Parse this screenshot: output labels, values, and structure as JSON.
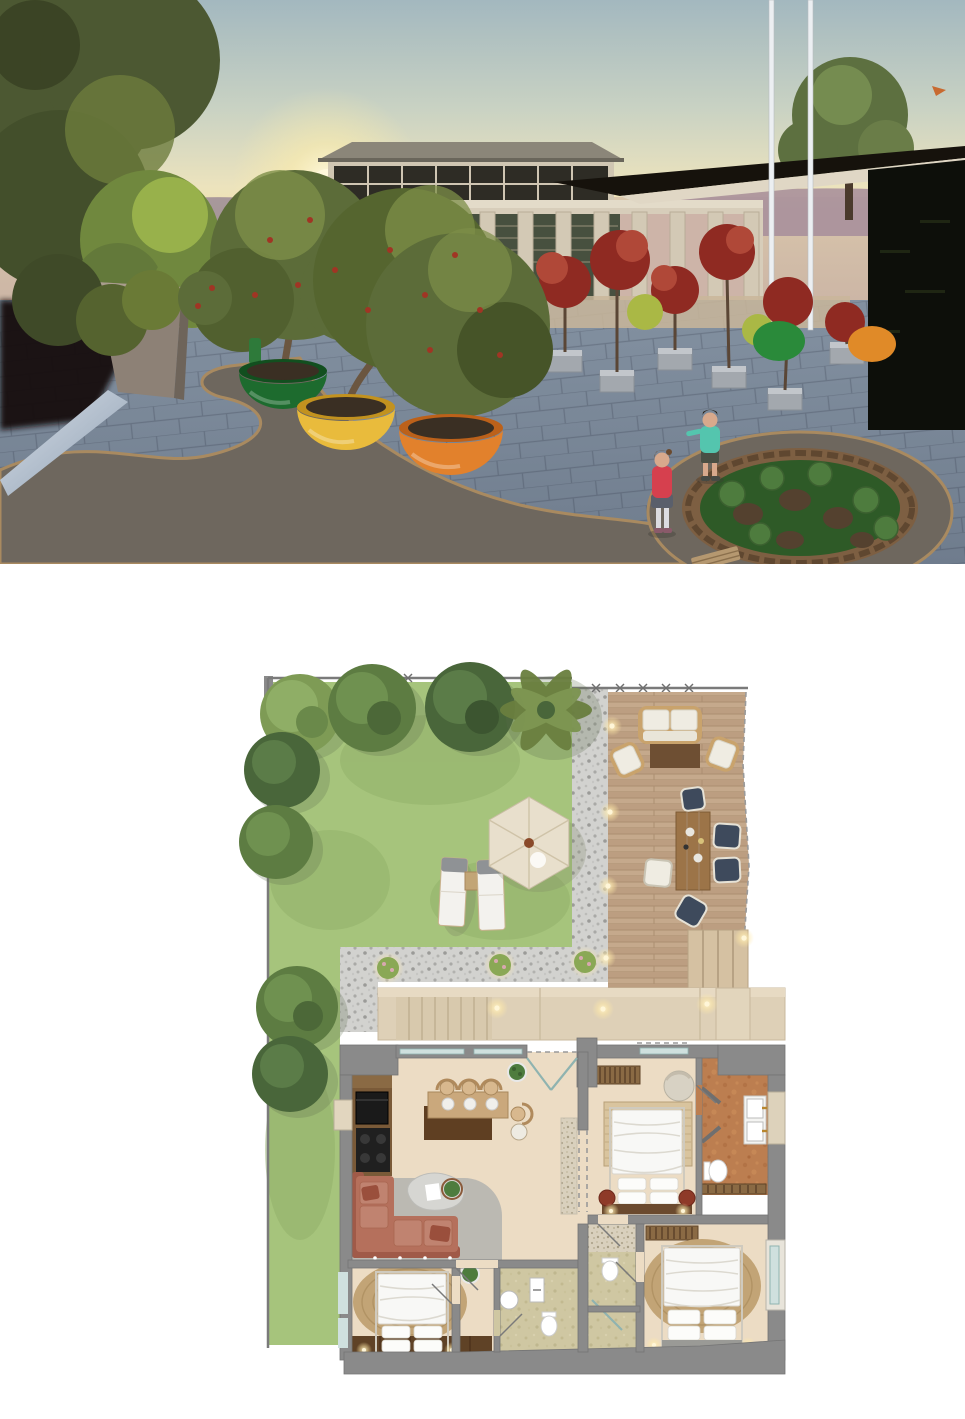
{
  "presentation": {
    "panels": [
      {
        "id": "exterior-render",
        "kind": "3d-render",
        "description": "Sunset eye-level render of a stone colonnade building on a flagstone plaza with olive trees in oversized glossy pots, a curved path, a round timber planter bed and two children"
      },
      {
        "id": "site-floor-plan",
        "kind": "floor-plan",
        "description": "Top-down rendered plan of a lawn garden with trees, gravel paths, timber deck with lounge and dining sets, stepped walkway and a furnished apartment with living-kitchen, three bedrooms and three bathrooms"
      }
    ]
  },
  "render": {
    "sky": {
      "top": "#a3b8bf",
      "mid": "#e9e0bd",
      "glow": "#f9d67b",
      "sun": "#fff8dd"
    },
    "sea": {
      "far": "#d9c6ab",
      "near": "#c9b2a4"
    },
    "hills": "#a9909b",
    "building": {
      "stone": "#d7cdba",
      "cornice": "#e3dbc9",
      "glass": "#47503f",
      "roof": "#8b8679"
    },
    "canopy": {
      "top": "#16120c",
      "underside": "#e0d7c5",
      "dark_wall": "#0d0f0a",
      "poles": "#eceff2"
    },
    "plaza": {
      "stone": "#8391a1",
      "joints": "#6e7a8a",
      "path": "#6e675e",
      "path_edge": "#a98a60",
      "near_strip": "#c9b69a"
    },
    "trees": {
      "olive": "#5c6c39",
      "olive_dark": "#465428",
      "olive_light": "#7d8f48",
      "berries": "#a03524",
      "red_tree": "#8f2a22",
      "red_tree_light": "#b04838",
      "lime_tree": "#aab845",
      "big_left": "#4c5832",
      "bright_left": "#70883e"
    },
    "pots": [
      {
        "name": "large-green-pot",
        "color": "#1d6b2e",
        "rim": "#124f1f"
      },
      {
        "name": "large-yellow-pot",
        "color": "#e9bb3c",
        "rim": "#c2921f"
      },
      {
        "name": "large-orange-pot",
        "color": "#e2812c",
        "rim": "#bc611a"
      },
      {
        "name": "small-green-pot",
        "color": "#2a8a3a"
      },
      {
        "name": "small-orange-pot",
        "color": "#e08a28"
      }
    ],
    "garden_bed": {
      "rim": "#7d5f42",
      "grass": "#2e5a27",
      "artichoke": "#4e7c3e",
      "rock": "#54412f",
      "bench": "#b59870"
    },
    "children": [
      {
        "role": "girl",
        "top_color": "#d6404e",
        "skirt_color": "#5a5f6b",
        "leggings": "#dcdce0"
      },
      {
        "role": "boy",
        "shirt_color": "#54c5ae",
        "shorts_color": "#4a4f44"
      }
    ]
  },
  "floor_plan": {
    "site": {
      "lawn_color": "#a6c47c",
      "gravel_color": "#d2d2cf",
      "boundary_color": "#7a7a7a",
      "tree_colors": {
        "dark": "#49663a",
        "mid": "#5d7c42",
        "light": "#7e9b55",
        "palm": "#6a7f3f"
      },
      "trees_count": 8,
      "shrubs_count": 3
    },
    "garden": {
      "parasol_color": "#e8dfcc",
      "parasol_hub": "#8a4a2a",
      "loungers": 2,
      "lounger_color": "#f3f2ee",
      "side_table_color": "#c2a576"
    },
    "deck": {
      "wood_color": "#bc9e81",
      "rug_color": "#6e4f33",
      "table_color": "#9c7448",
      "chair_navy": "#3e4a5c",
      "cushion_white": "#efece2",
      "frame_wood": "#c9a36c",
      "stairs_color": "#d5c1a2",
      "lights": 5,
      "stairs_steps": 4,
      "furniture": [
        "2-seat sofa",
        "2 lounge chairs",
        "outdoor rug",
        "dining table",
        "6 dining chairs"
      ]
    },
    "walkway": {
      "stone_color": "#ded0b7",
      "steps_color": "#d8c9ad",
      "lights": 3,
      "shrub_color": "#8aa855",
      "bloom_color": "#d8a8b0"
    },
    "house": {
      "wall_color": "#8a8a8a",
      "floor_color": "#ecdcc4",
      "colors": {
        "sofa": "#b5705c",
        "sofa_back": "#a05a48",
        "jute_rug": "#c2a476",
        "bed_linen": "#f8f8f6",
        "terracotta": "#bc7e50",
        "sand": "#cfc7a2",
        "wood_dark": "#6b4a2e",
        "ottoman": "#8e3a28",
        "island_wood": "#caa87c",
        "island_base": "#5f3f22",
        "kitchen_wood": "#7a5a38",
        "glass": "#cfe0de"
      },
      "rooms": [
        {
          "name": "living-kitchen",
          "items": [
            "kitchen counter",
            "oven",
            "cooktop",
            "island bar",
            "4 bar stools",
            "corner sofa",
            "organic coffee table",
            "area rug",
            "pebble runner",
            "potted plant",
            "double entrance door",
            "sliding glass doors"
          ]
        },
        {
          "name": "master-bedroom",
          "items": [
            "double bed",
            "striped jute rug",
            "slatted bench",
            "round armchair",
            "2 red ottomans",
            "wood headboard wall"
          ]
        },
        {
          "name": "ensuite-bathroom",
          "items": [
            "double vanity with brass taps",
            "toilet",
            "terracotta tile floor",
            "angled privacy walls",
            "wood mat"
          ]
        },
        {
          "name": "bedroom-2",
          "items": [
            "double bed",
            "oval jute rug",
            "slatted bench",
            "side window"
          ]
        },
        {
          "name": "bathroom-2",
          "items": [
            "toilet",
            "shower screen",
            "sand tile floor"
          ]
        },
        {
          "name": "bedroom-3",
          "items": [
            "double bed",
            "oval jute rug",
            "dark wood floor strip",
            "potted plant"
          ]
        },
        {
          "name": "bathroom-3",
          "items": [
            "round basin",
            "vanity basin",
            "toilet",
            "sand tile floor"
          ]
        }
      ]
    }
  }
}
